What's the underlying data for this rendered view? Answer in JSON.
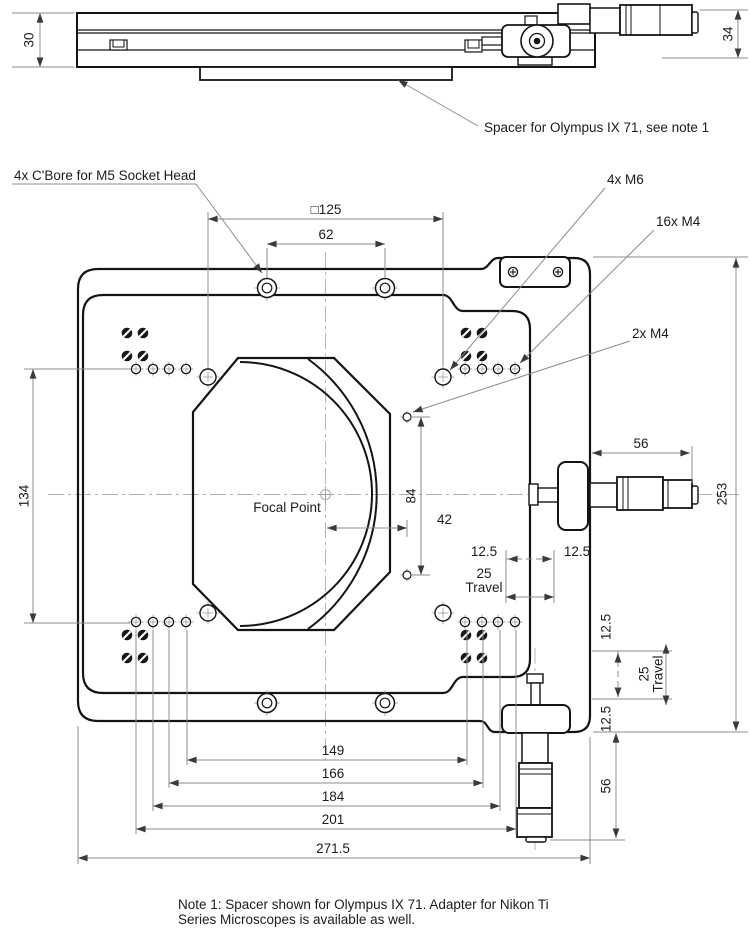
{
  "side_view": {
    "dim_height_left": "30",
    "dim_height_right": "34",
    "spacer_note": "Spacer for Olympus IX 71, see note 1"
  },
  "main_view": {
    "labels": {
      "cbore": "4x C'Bore for M5 Socket Head",
      "m6": "4x M6",
      "m4_16": "16x M4",
      "m4_2": "2x M4",
      "focal_point": "Focal Point"
    },
    "dims": {
      "square125": "□125",
      "d62": "62",
      "d134": "134",
      "d84": "84",
      "d42": "42",
      "d56_right": "56",
      "d253": "253",
      "d12_5_left": "12.5",
      "d12_5_right": "12.5",
      "travel_h_25": "25",
      "travel_h_word": "Travel",
      "d12_5_top": "12.5",
      "d12_5_bottom": "12.5",
      "travel_v_25": "25",
      "travel_v_word": "Travel",
      "d56_bottom": "56",
      "d149": "149",
      "d166": "166",
      "d184": "184",
      "d201": "201",
      "d271_5": "271.5"
    }
  },
  "note": {
    "line1": "Note 1:  Spacer shown for Olympus IX 71.  Adapter for Nikon Ti",
    "line2": "Series Microscopes is available as well."
  },
  "colors": {
    "outline": "#141414",
    "dimension": "#8c8c8c",
    "centerline": "#b0b0b0"
  }
}
